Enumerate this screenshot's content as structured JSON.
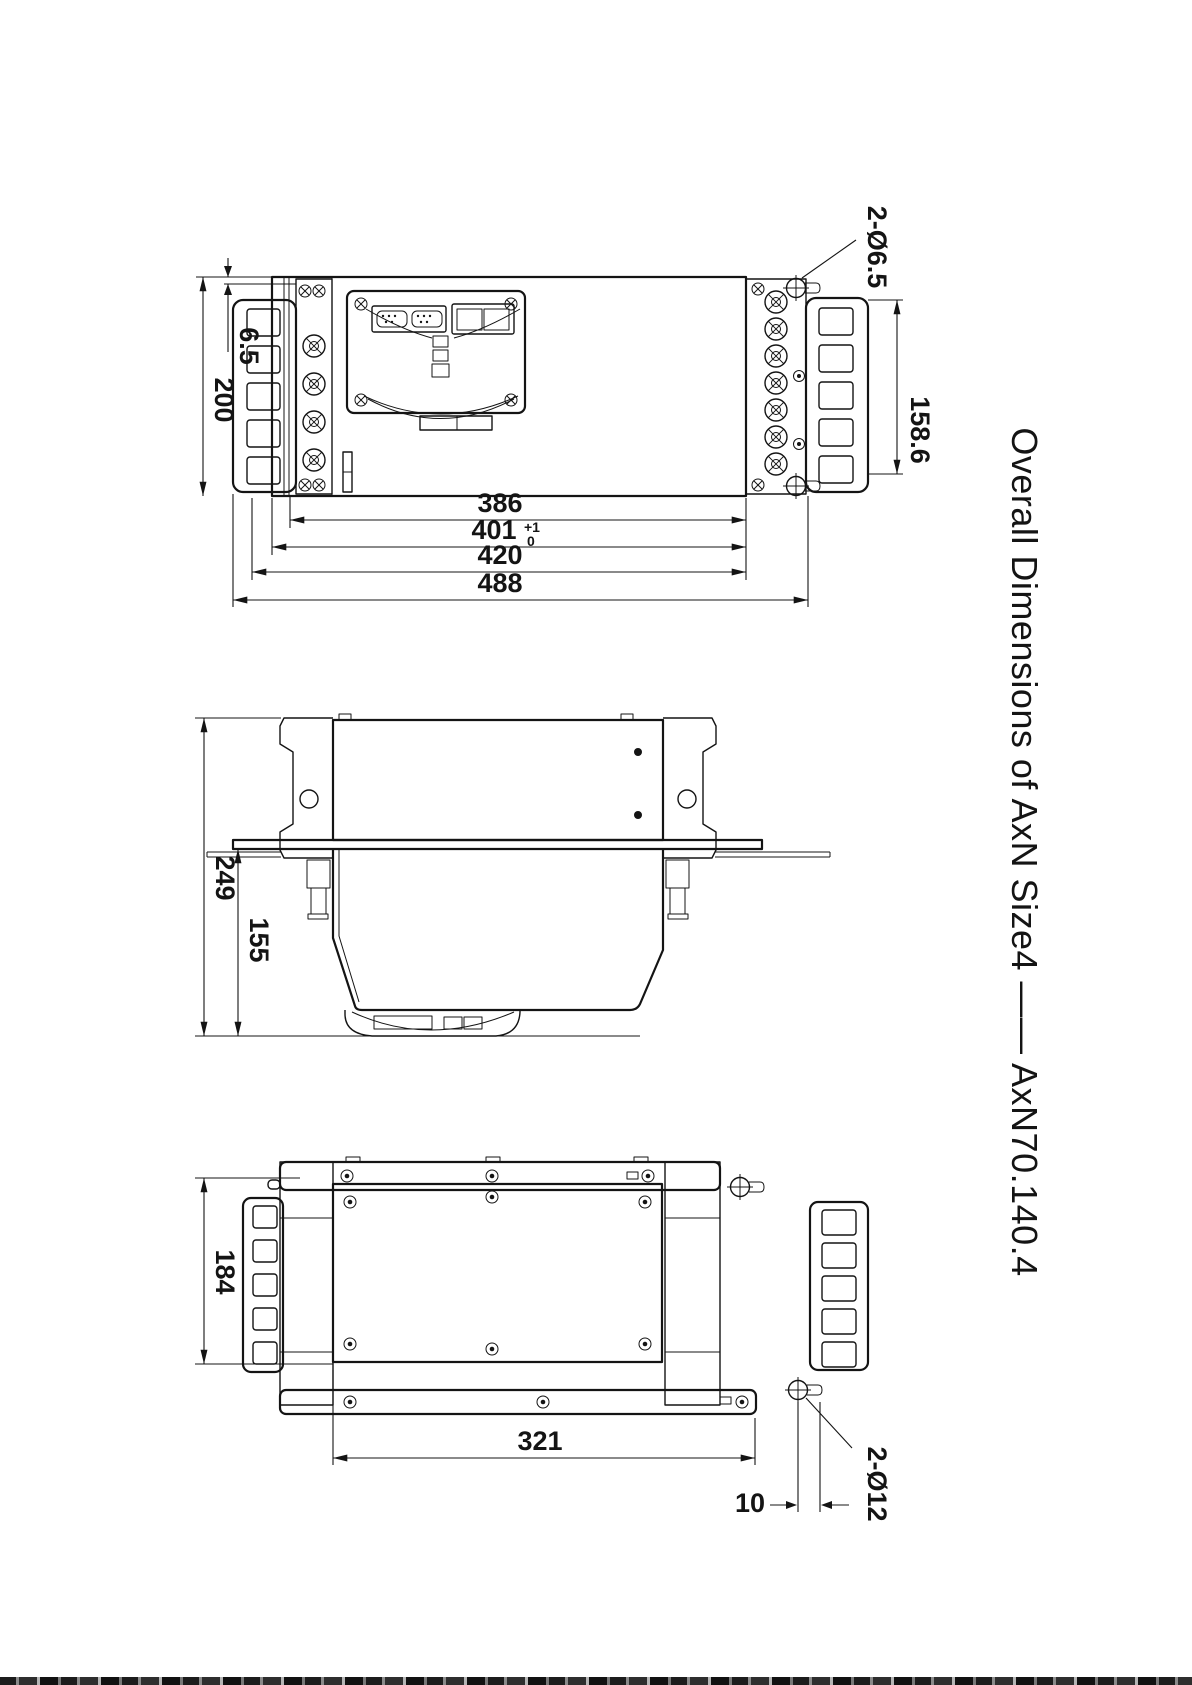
{
  "title": {
    "text": "Overall Dimensions of AxN Size4 —— AxN70.140.4"
  },
  "views": {
    "front": {
      "dims": {
        "flange_offset": "6.5",
        "body_height": "200",
        "mount_hole_callout": "2-Ø6.5",
        "side_bracket_height": "158.6",
        "width_a": "386",
        "width_b": "401",
        "width_b_tol_upper": "+1",
        "width_b_tol_lower": "0",
        "width_c": "420",
        "width_total": "488"
      }
    },
    "side": {
      "dims": {
        "depth_total": "249",
        "depth_lower": "155"
      }
    },
    "bottom": {
      "dims": {
        "body_width": "184",
        "base_length": "321",
        "stud_offset": "10",
        "stud_hole_callout": "2-Ø12"
      }
    }
  }
}
